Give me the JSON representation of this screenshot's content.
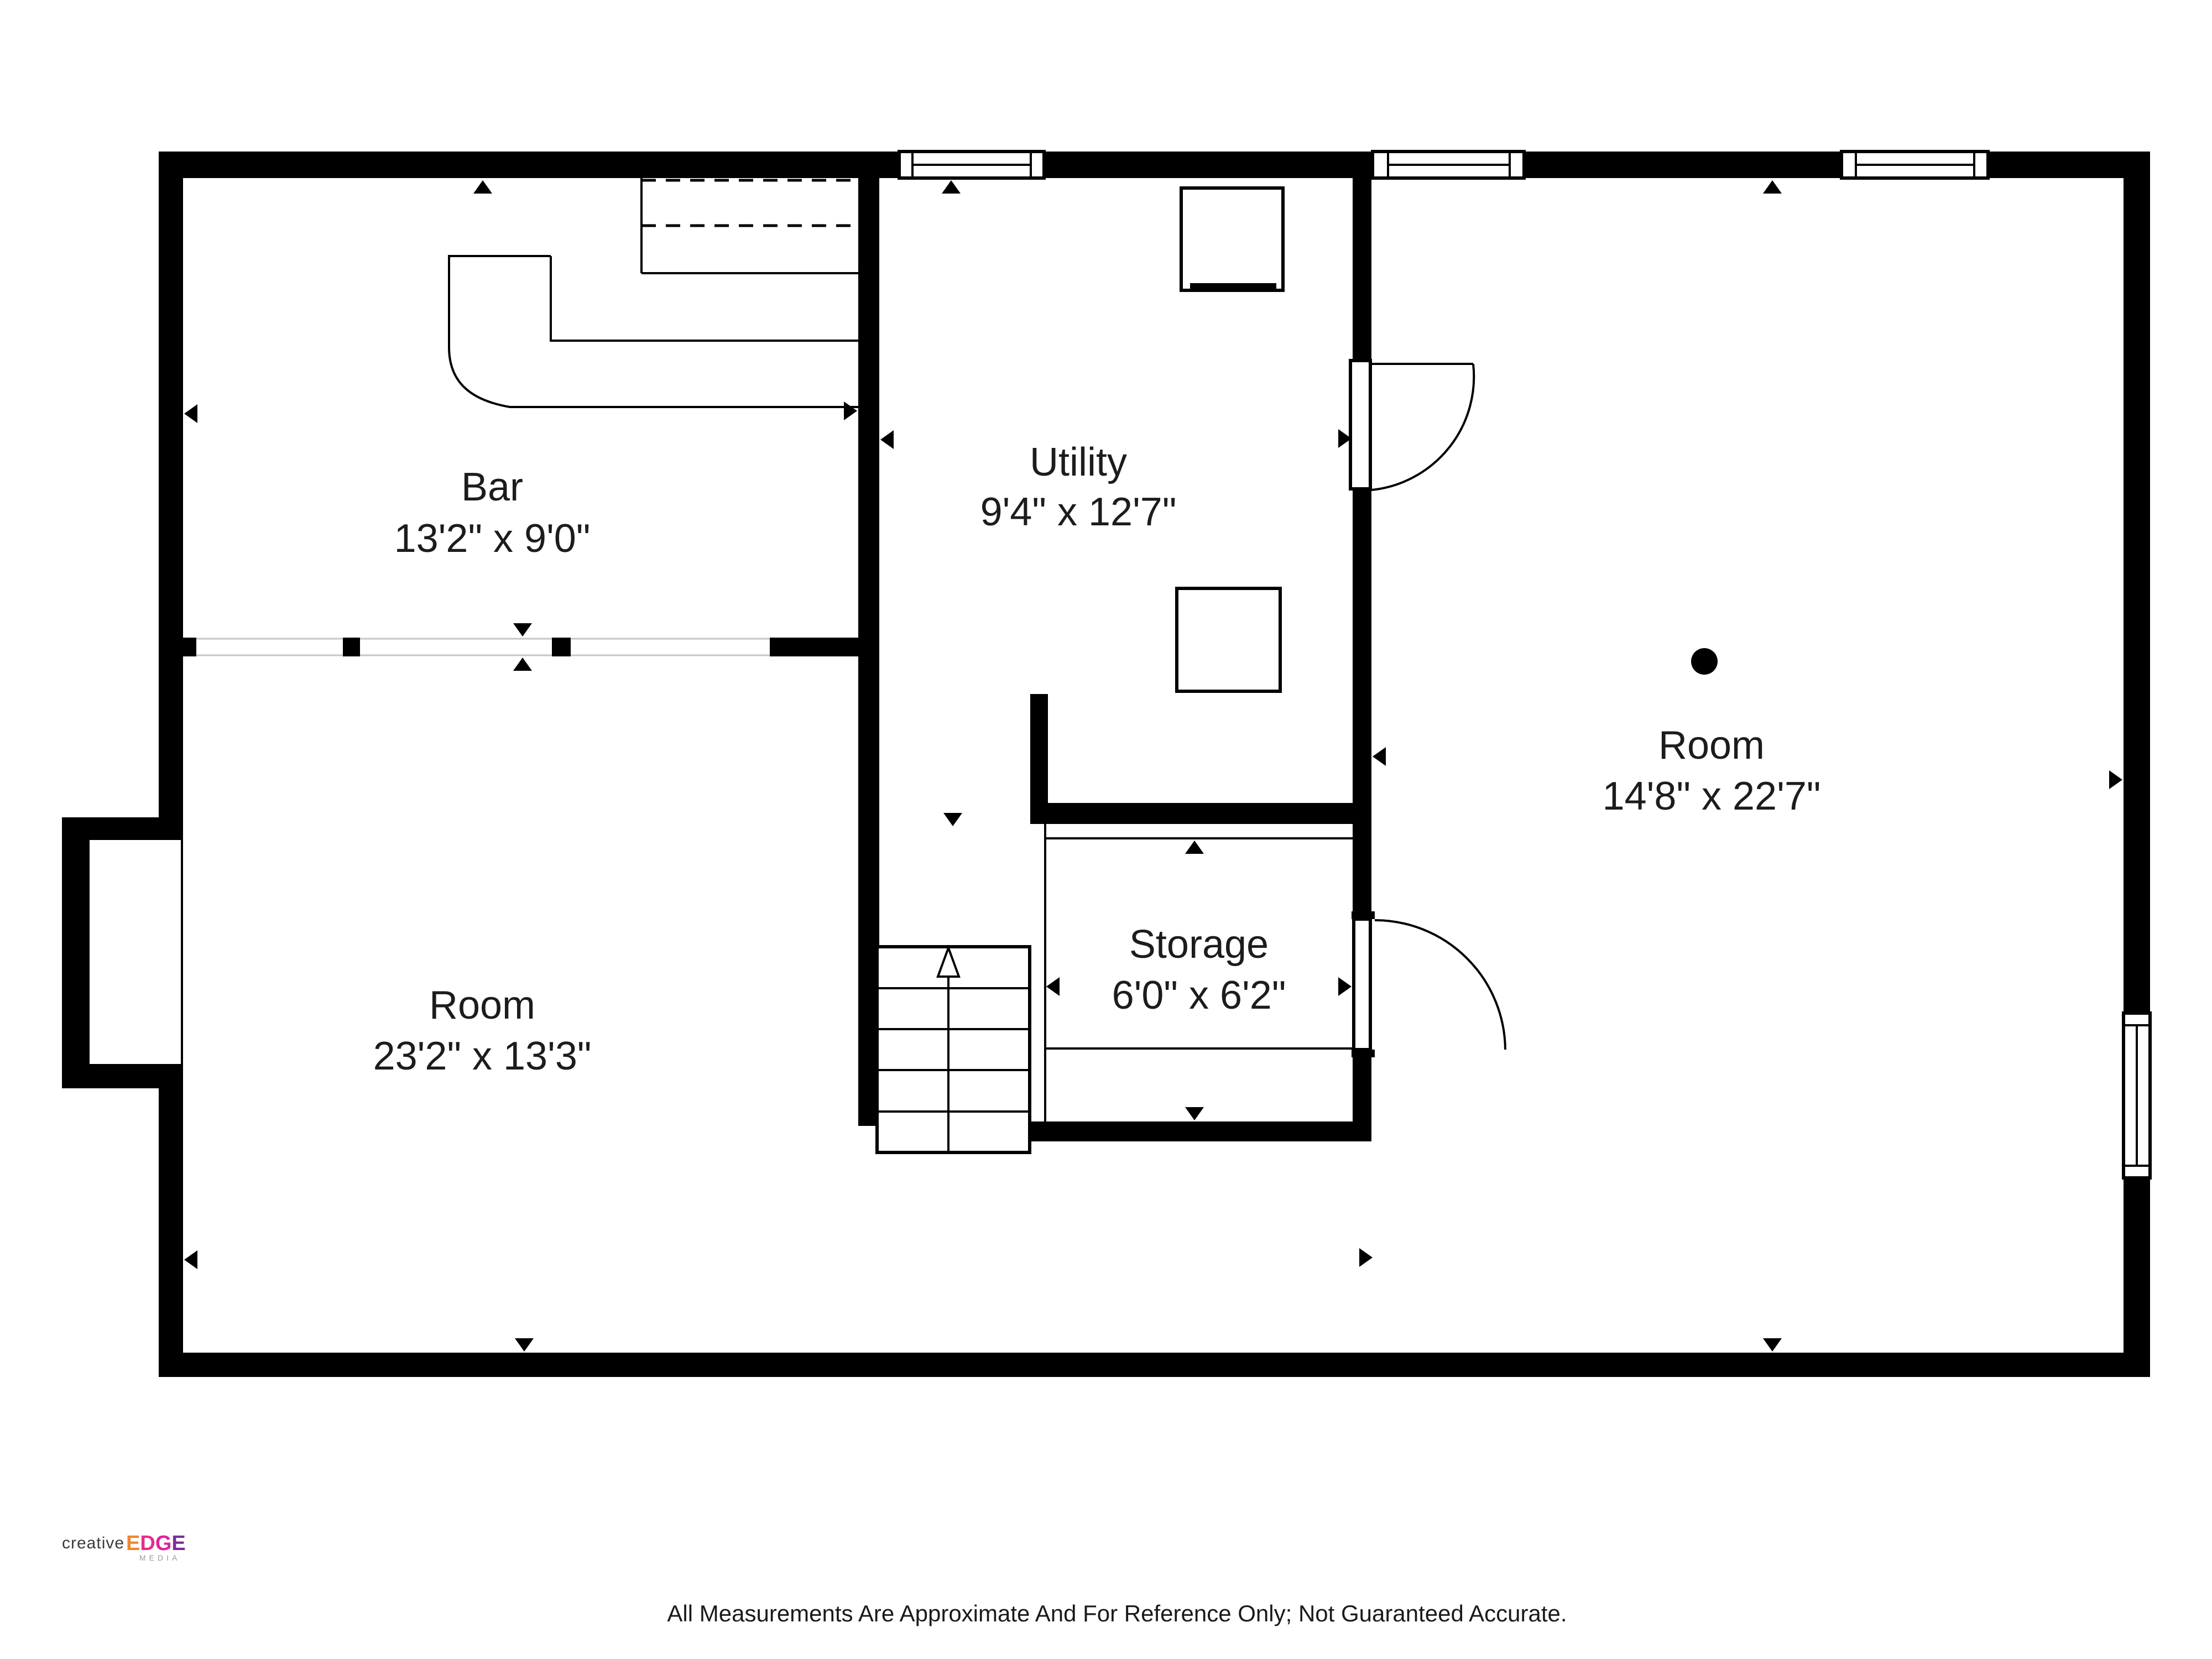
{
  "rooms": {
    "bar": {
      "name": "Bar",
      "dims": "13'2\" x 9'0\""
    },
    "utility": {
      "name": "Utility",
      "dims": "9'4\" x 12'7\""
    },
    "room_right": {
      "name": "Room",
      "dims": "14'8\" x 22'7\""
    },
    "room_left": {
      "name": "Room",
      "dims": "23'2\" x 13'3\""
    },
    "storage": {
      "name": "Storage",
      "dims": "6'0\" x 6'2\""
    }
  },
  "footer": {
    "disclaimer": "All Measurements Are Approximate And For Reference Only; Not Guaranteed Accurate."
  },
  "logo": {
    "creative": "creative",
    "media": "MEDIA",
    "edge_letters": [
      {
        "ch": "E",
        "style": "fill:#f0862c"
      },
      {
        "ch": "D",
        "style": "fill:#e62e8a"
      },
      {
        "ch": "G",
        "style": "fill:#e0219e"
      },
      {
        "ch": "E",
        "style": "fill:#7a2e9e"
      }
    ]
  },
  "colors": {
    "wall": "#000000",
    "label_text": "#1c1c1c",
    "logo_creative": "#3b3b3b",
    "logo_media": "#9a9a9a",
    "logo_edge_orange": "#f0862c",
    "logo_edge_magenta": "#e62e8a",
    "logo_edge_pink": "#e0219e",
    "logo_edge_purple": "#7a2e9e"
  }
}
